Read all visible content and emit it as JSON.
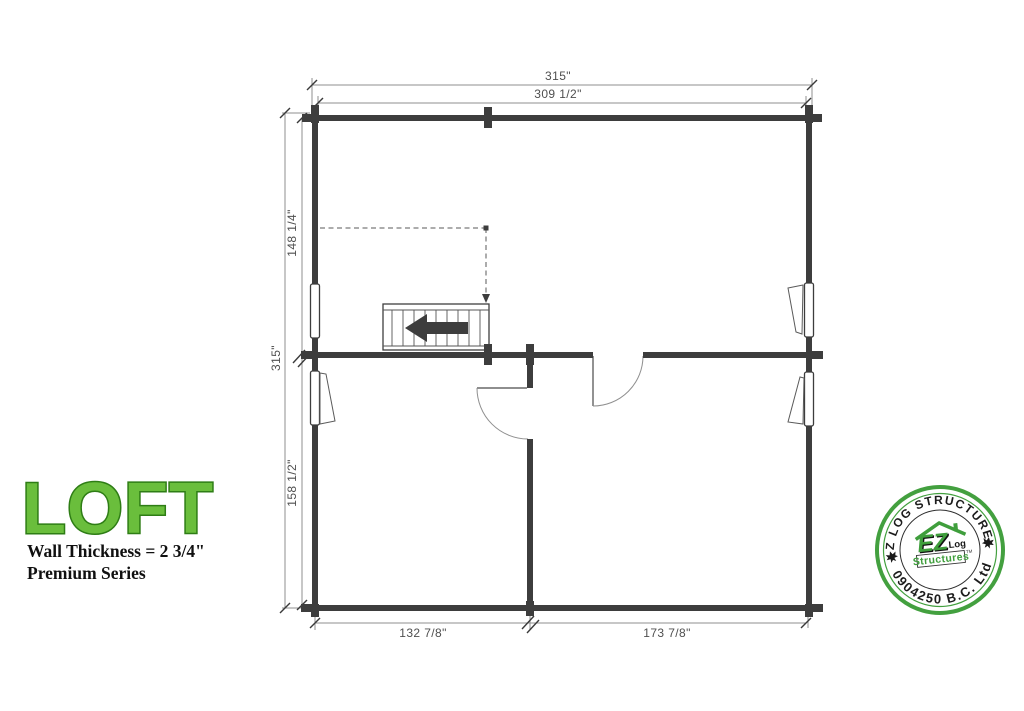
{
  "title_block": {
    "title": "LOFT",
    "wall_thickness": "Wall Thickness = 2 3/4\"",
    "series": "Premium Series"
  },
  "dimensions": {
    "top_overall": "315\"",
    "top_inner": "309 1/2\"",
    "left_overall": "315\"",
    "loft_depth": "148 1/4\"",
    "lower_depth": "158 1/2\"",
    "bottom_left_room": "132 7/8\"",
    "bottom_right_room": "173 7/8\""
  },
  "stamp": {
    "arc_top": "EZ LOG STRUCTURES",
    "arc_bottom": "0904250 B.C. Ltd",
    "ez": "EZ",
    "log": "Log",
    "structures": "Structures",
    "tm": "TM"
  },
  "colors": {
    "wall": "#3d3d3d",
    "thin_line": "#8f8f8f",
    "dimension_text": "#4f4f4f",
    "title_green_fill": "#6abe3c",
    "title_green_outline": "#2e7d15",
    "stamp_green": "#43a03f"
  }
}
